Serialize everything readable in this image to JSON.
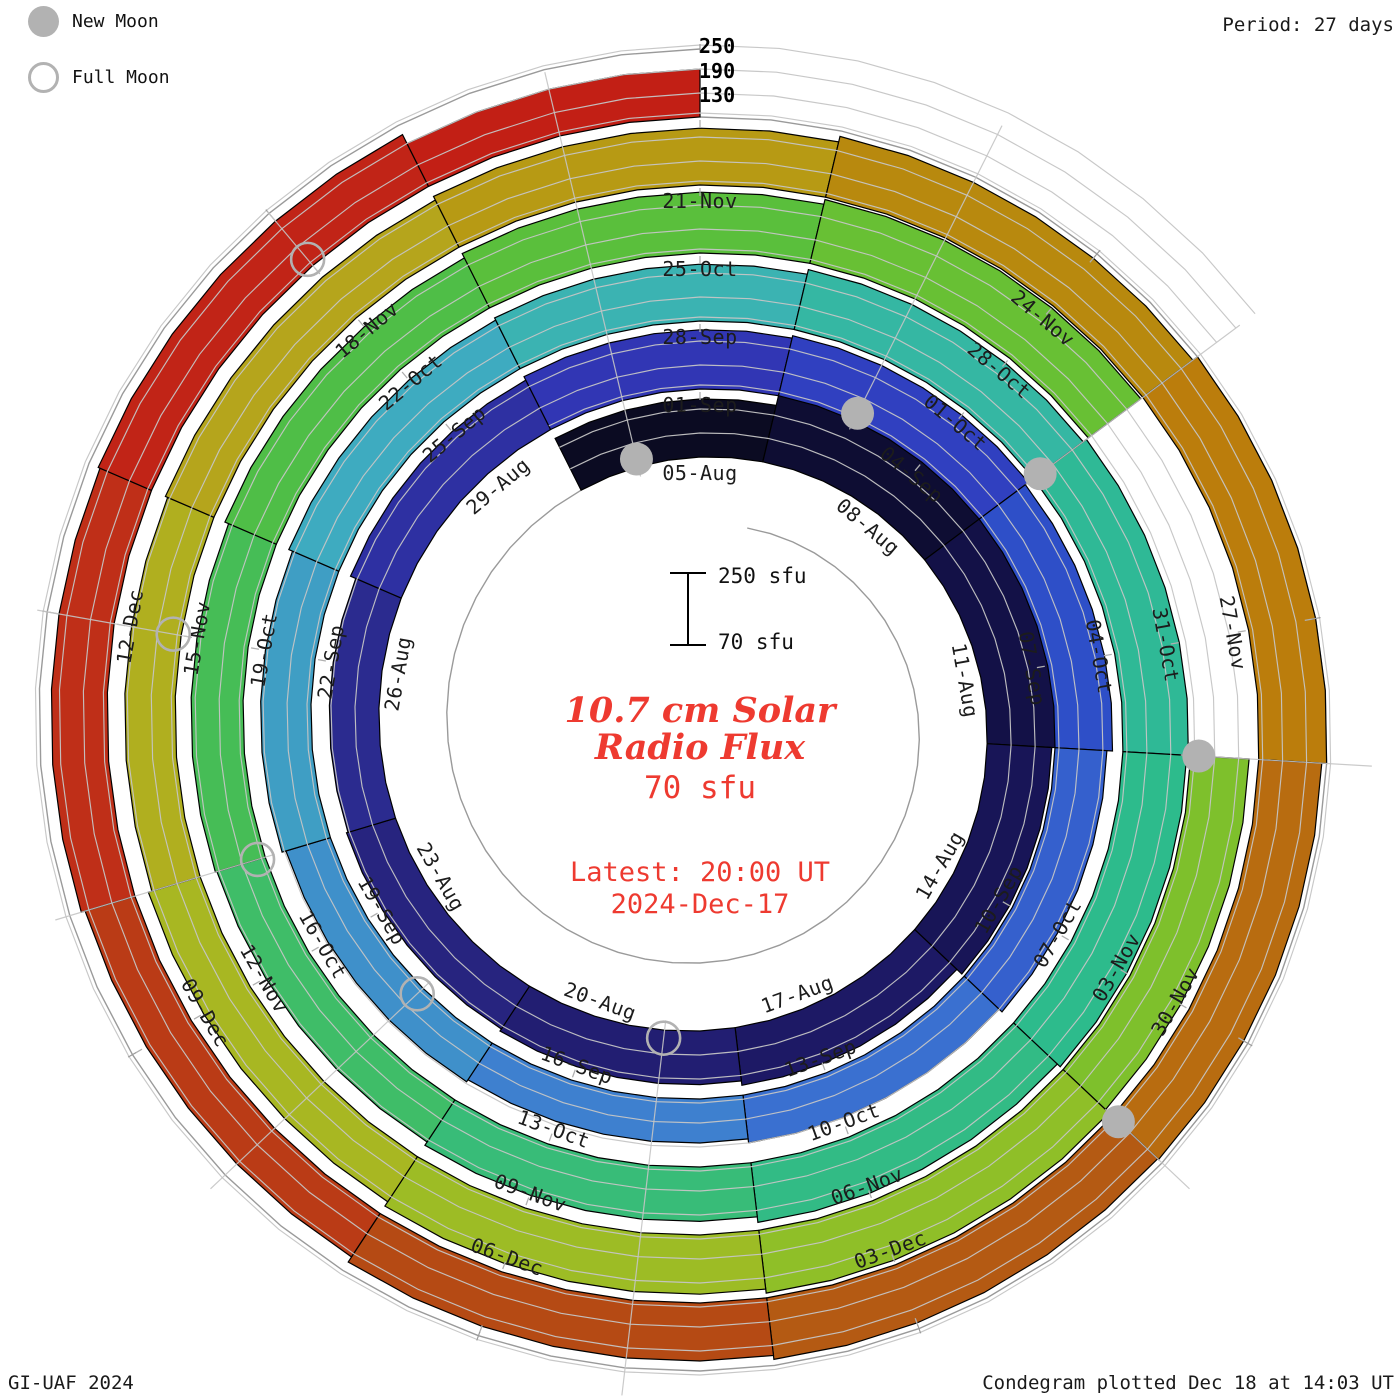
{
  "header": {
    "period_label": "Period: 27 days"
  },
  "legend": {
    "new_moon": "New Moon",
    "full_moon": "Full Moon"
  },
  "footer": {
    "left": "GI-UAF 2024",
    "right": "Condegram plotted Dec 18 at 14:03 UT"
  },
  "center": {
    "title_line1": "10.7 cm Solar",
    "title_line2": "Radio Flux",
    "current_value": "70 sfu",
    "latest_line1": "Latest: 20:00 UT",
    "latest_line2": "2024-Dec-17"
  },
  "scale_bar": {
    "top_label": "250 sfu",
    "bottom_label": "70 sfu"
  },
  "radial_axis": {
    "labels": [
      "250",
      "190",
      "130"
    ]
  },
  "chart_data": {
    "type": "bar",
    "variant": "condegram-spiral-polar",
    "title": "10.7 cm Solar Radio Flux",
    "units": "sfu",
    "period_days": 27,
    "flux_range": [
      70,
      250
    ],
    "gridlines_sfu": [
      130,
      190,
      250
    ],
    "start_date": "2024-Aug-03",
    "latest": "2024-Dec-17 20:00 UT",
    "data_end_day": 137,
    "geometry": {
      "cx": 700,
      "cy": 727,
      "r0": 270,
      "ring_spacing": 68,
      "px_per_sfu": 0.4,
      "day_ref": 2,
      "track_start_day": -24,
      "track_end_day": 164,
      "label_offset": -16,
      "moon_offset": 8,
      "moon_radius": 16.5
    },
    "colors": {
      "divider": "#000000",
      "gridline": "#c5c5c5",
      "track": "#9a9a9a",
      "tick": "#b0b0b0",
      "moon": "#b2b2b2",
      "label": "#1c1c1c",
      "accent_red": "#ee3a30"
    },
    "segments": [
      {
        "date": "03-Aug",
        "day": 0,
        "flux": 215,
        "color": "#0b0b22"
      },
      {
        "date": "06-Aug",
        "day": 3,
        "flux": 244,
        "color": "#0e0d33"
      },
      {
        "date": "09-Aug",
        "day": 6,
        "flux": 246,
        "color": "#131147"
      },
      {
        "date": "12-Aug",
        "day": 9,
        "flux": 232,
        "color": "#181557"
      },
      {
        "date": "15-Aug",
        "day": 12,
        "flux": 215,
        "color": "#1d1965"
      },
      {
        "date": "18-Aug",
        "day": 15,
        "flux": 204,
        "color": "#221e72"
      },
      {
        "date": "21-Aug",
        "day": 18,
        "flux": 198,
        "color": "#27247f"
      },
      {
        "date": "24-Aug",
        "day": 21,
        "flux": 194,
        "color": "#2b2b8f"
      },
      {
        "date": "27-Aug",
        "day": 24,
        "flux": 208,
        "color": "#2e30a2"
      },
      {
        "date": "30-Aug",
        "day": 27,
        "flux": 218,
        "color": "#3136b4"
      },
      {
        "date": "02-Sep",
        "day": 30,
        "flux": 224,
        "color": "#3040c0"
      },
      {
        "date": "05-Sep",
        "day": 33,
        "flux": 214,
        "color": "#2e4fc8"
      },
      {
        "date": "08-Sep",
        "day": 36,
        "flux": 200,
        "color": "#3560cd"
      },
      {
        "date": "11-Sep",
        "day": 39,
        "flux": 190,
        "color": "#3a70d0"
      },
      {
        "date": "14-Sep",
        "day": 42,
        "flux": 180,
        "color": "#3e80cf"
      },
      {
        "date": "17-Sep",
        "day": 45,
        "flux": 186,
        "color": "#3f90ca"
      },
      {
        "date": "20-Sep",
        "day": 48,
        "flux": 196,
        "color": "#3f9ec4"
      },
      {
        "date": "23-Sep",
        "day": 51,
        "flux": 206,
        "color": "#3eabc0"
      },
      {
        "date": "26-Sep",
        "day": 54,
        "flux": 212,
        "color": "#3bb3b2"
      },
      {
        "date": "29-Sep",
        "day": 57,
        "flux": 224,
        "color": "#35b7a3"
      },
      {
        "date": "02-Oct",
        "day": 60,
        "flux": 234,
        "color": "#2fb996"
      },
      {
        "date": "05-Oct",
        "day": 63,
        "flux": 230,
        "color": "#2dbb8c"
      },
      {
        "date": "08-Oct",
        "day": 66,
        "flux": 220,
        "color": "#32bb85"
      },
      {
        "date": "11-Oct",
        "day": 69,
        "flux": 206,
        "color": "#38bc78"
      },
      {
        "date": "14-Oct",
        "day": 72,
        "flux": 196,
        "color": "#3fbd68"
      },
      {
        "date": "17-Oct",
        "day": 75,
        "flux": 200,
        "color": "#46bd56"
      },
      {
        "date": "20-Oct",
        "day": 78,
        "flux": 210,
        "color": "#4fbe47"
      },
      {
        "date": "23-Oct",
        "day": 81,
        "flux": 222,
        "color": "#5abf3c"
      },
      {
        "date": "26-Oct",
        "day": 84,
        "flux": 234,
        "color": "#68c034"
      },
      {
        "date": "29-Oct",
        "day": 87,
        "flux": null,
        "color": "#76c02f",
        "gap": true
      },
      {
        "date": "01-Nov",
        "day": 90,
        "flux": 216,
        "color": "#7ec02c"
      },
      {
        "date": "04-Nov",
        "day": 93,
        "flux": 228,
        "color": "#8fbf28"
      },
      {
        "date": "07-Nov",
        "day": 96,
        "flux": 218,
        "color": "#9dbc25"
      },
      {
        "date": "10-Nov",
        "day": 99,
        "flux": 205,
        "color": "#a8b722"
      },
      {
        "date": "13-Nov",
        "day": 102,
        "flux": 196,
        "color": "#b0af1f"
      },
      {
        "date": "16-Nov",
        "day": 105,
        "flux": 202,
        "color": "#b5a51c"
      },
      {
        "date": "19-Nov",
        "day": 108,
        "flux": 212,
        "color": "#b79a14"
      },
      {
        "date": "22-Nov",
        "day": 111,
        "flux": 226,
        "color": "#b8890e"
      },
      {
        "date": "25-Nov",
        "day": 114,
        "flux": 240,
        "color": "#bb7d0c"
      },
      {
        "date": "28-Nov",
        "day": 117,
        "flux": 228,
        "color": "#b86c10"
      },
      {
        "date": "01-Dec",
        "day": 120,
        "flux": 225,
        "color": "#b45a13"
      },
      {
        "date": "04-Dec",
        "day": 123,
        "flux": 215,
        "color": "#b54a14"
      },
      {
        "date": "07-Dec",
        "day": 126,
        "flux": 200,
        "color": "#ba3b16"
      },
      {
        "date": "10-Dec",
        "day": 129,
        "flux": 210,
        "color": "#bf2f18"
      },
      {
        "date": "13-Dec",
        "day": 132,
        "flux": 215,
        "color": "#c12417"
      },
      {
        "date": "16-Dec",
        "day": 135,
        "flux": 190,
        "color": "#c21f15"
      }
    ],
    "date_labels": [
      {
        "label": "05-Aug",
        "day": 2
      },
      {
        "label": "08-Aug",
        "day": 5
      },
      {
        "label": "11-Aug",
        "day": 8
      },
      {
        "label": "14-Aug",
        "day": 11
      },
      {
        "label": "17-Aug",
        "day": 14
      },
      {
        "label": "20-Aug",
        "day": 17
      },
      {
        "label": "23-Aug",
        "day": 20
      },
      {
        "label": "26-Aug",
        "day": 23
      },
      {
        "label": "29-Aug",
        "day": 26
      },
      {
        "label": "01-Sep",
        "day": 29
      },
      {
        "label": "04-Sep",
        "day": 32
      },
      {
        "label": "07-Sep",
        "day": 35
      },
      {
        "label": "10-Sep",
        "day": 38
      },
      {
        "label": "13-Sep",
        "day": 41
      },
      {
        "label": "16-Sep",
        "day": 44
      },
      {
        "label": "19-Sep",
        "day": 47
      },
      {
        "label": "22-Sep",
        "day": 50
      },
      {
        "label": "25-Sep",
        "day": 53
      },
      {
        "label": "28-Sep",
        "day": 56
      },
      {
        "label": "01-Oct",
        "day": 59
      },
      {
        "label": "04-Oct",
        "day": 62
      },
      {
        "label": "07-Oct",
        "day": 65
      },
      {
        "label": "10-Oct",
        "day": 68
      },
      {
        "label": "13-Oct",
        "day": 71
      },
      {
        "label": "16-Oct",
        "day": 74
      },
      {
        "label": "19-Oct",
        "day": 77
      },
      {
        "label": "22-Oct",
        "day": 80
      },
      {
        "label": "25-Oct",
        "day": 83
      },
      {
        "label": "28-Oct",
        "day": 86
      },
      {
        "label": "31-Oct",
        "day": 89
      },
      {
        "label": "03-Nov",
        "day": 92
      },
      {
        "label": "06-Nov",
        "day": 95
      },
      {
        "label": "09-Nov",
        "day": 98
      },
      {
        "label": "12-Nov",
        "day": 101
      },
      {
        "label": "15-Nov",
        "day": 104
      },
      {
        "label": "18-Nov",
        "day": 107
      },
      {
        "label": "21-Nov",
        "day": 110
      },
      {
        "label": "24-Nov",
        "day": 113
      },
      {
        "label": "27-Nov",
        "day": 116
      },
      {
        "label": "30-Nov",
        "day": 119
      },
      {
        "label": "03-Dec",
        "day": 122
      },
      {
        "label": "06-Dec",
        "day": 125
      },
      {
        "label": "09-Dec",
        "day": 128
      },
      {
        "label": "12-Dec",
        "day": 131
      }
    ],
    "moons": [
      {
        "type": "new",
        "date": "04-Aug",
        "day": 1
      },
      {
        "type": "full",
        "date": "19-Aug",
        "day": 16
      },
      {
        "type": "new",
        "date": "03-Sep",
        "day": 31
      },
      {
        "type": "full",
        "date": "18-Sep",
        "day": 46
      },
      {
        "type": "new",
        "date": "02-Oct",
        "day": 60
      },
      {
        "type": "full",
        "date": "17-Oct",
        "day": 75
      },
      {
        "type": "new",
        "date": "01-Nov",
        "day": 90
      },
      {
        "type": "full",
        "date": "15-Nov",
        "day": 104
      },
      {
        "type": "new",
        "date": "01-Dec",
        "day": 120
      },
      {
        "type": "full",
        "date": "15-Dec",
        "day": 134
      }
    ]
  }
}
